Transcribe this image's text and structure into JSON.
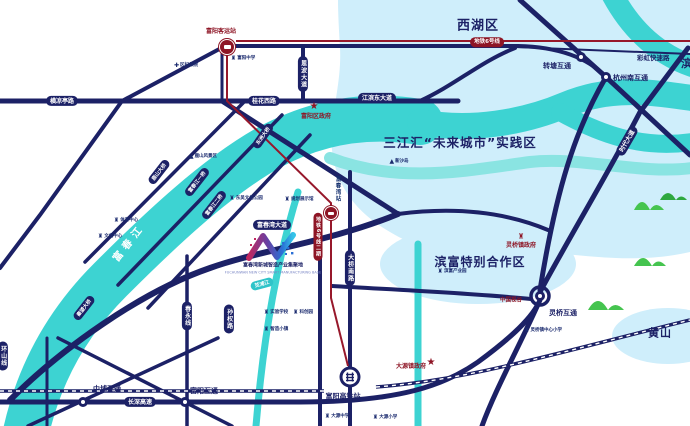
{
  "colors": {
    "road_navy": "#1c2166",
    "river_cyan": "#3dd3d2",
    "zone_pale_blue": "#cfeefb",
    "metro_red": "#97182b",
    "gov_red": "#8e1525",
    "mountain_green": "#45c44f",
    "background": "#ffffff"
  },
  "icons": {
    "star": "★",
    "building": "♜",
    "hospital": "✚",
    "mountain": "▲"
  },
  "districts": {
    "xihu": "西湖区",
    "binjiang": "滨江区",
    "sanjianghui": "三江汇“未来城市”实践区",
    "binfu": "滨富特别合作区",
    "huangshan": "黄山"
  },
  "roads": {
    "hengliangting": "横凉亭路",
    "guihua_west": "桂花西路",
    "jiangbin_east": "江滨东大道",
    "enbo": "恩波大道",
    "fuchunwan": "富春湾大道",
    "changshen": "长深高速",
    "caihong": "彩虹快速路",
    "daqiao_south": "大桥南路",
    "sunquan": "孙权路",
    "chunyong": "春永线",
    "huanshan": "环山线",
    "shidai": "时代大道"
  },
  "bridges": {
    "lushan": "鹿山大桥",
    "yiqiao": "富春江一桥",
    "erqiao": "富春江二桥",
    "dongzhou": "东洲大桥",
    "qinwang": "秦望大桥"
  },
  "interchanges": {
    "zhuantang": "转塘互通",
    "hangzhounan": "杭州南互通",
    "zhongbu": "中埔互通",
    "fuyang": "富阳互通",
    "lingqiao": "灵桥互通"
  },
  "metro": {
    "line6": "地铁6号线",
    "line6_phase2": "地铁6号线二期",
    "bus_station": "富阳客运站",
    "fuchunwan_station": "富春湾站"
  },
  "rail": {
    "station": "富阳高铁站"
  },
  "government": {
    "fuyang": "富阳区政府",
    "dayuan": "大源镇政府",
    "lingqiao": "灵桥镇政府",
    "china_vision": "中国视谷"
  },
  "waters": {
    "fuchun_river": "富春江",
    "xianpu": "苋浦江"
  },
  "pois": {
    "fubaoyuan": "区妇保院",
    "fuyang_school": "富阳中学",
    "lushan_scenic": "鹿山风景区",
    "dongwu_park": "东吴文化公园",
    "planning_hall": "规划展示馆",
    "sports_center": "体育中心",
    "culture_center": "文化中心",
    "xinsha_island": "新沙岛",
    "binfu_park": "滨富产业园",
    "lingqiao_school": "灵桥镇中心小学",
    "dayuan_school": "大源中学",
    "dayuan_primary": "大源小学",
    "experiment_school": "实验学校",
    "kechuang_park": "科创园",
    "zhizao_town": "智造小镇"
  },
  "logo": {
    "title": "富春湾新城智造产业集聚地",
    "subtitle": "FUCHUNWAN NEW CITY SMART MANUFACTURING BASE"
  }
}
